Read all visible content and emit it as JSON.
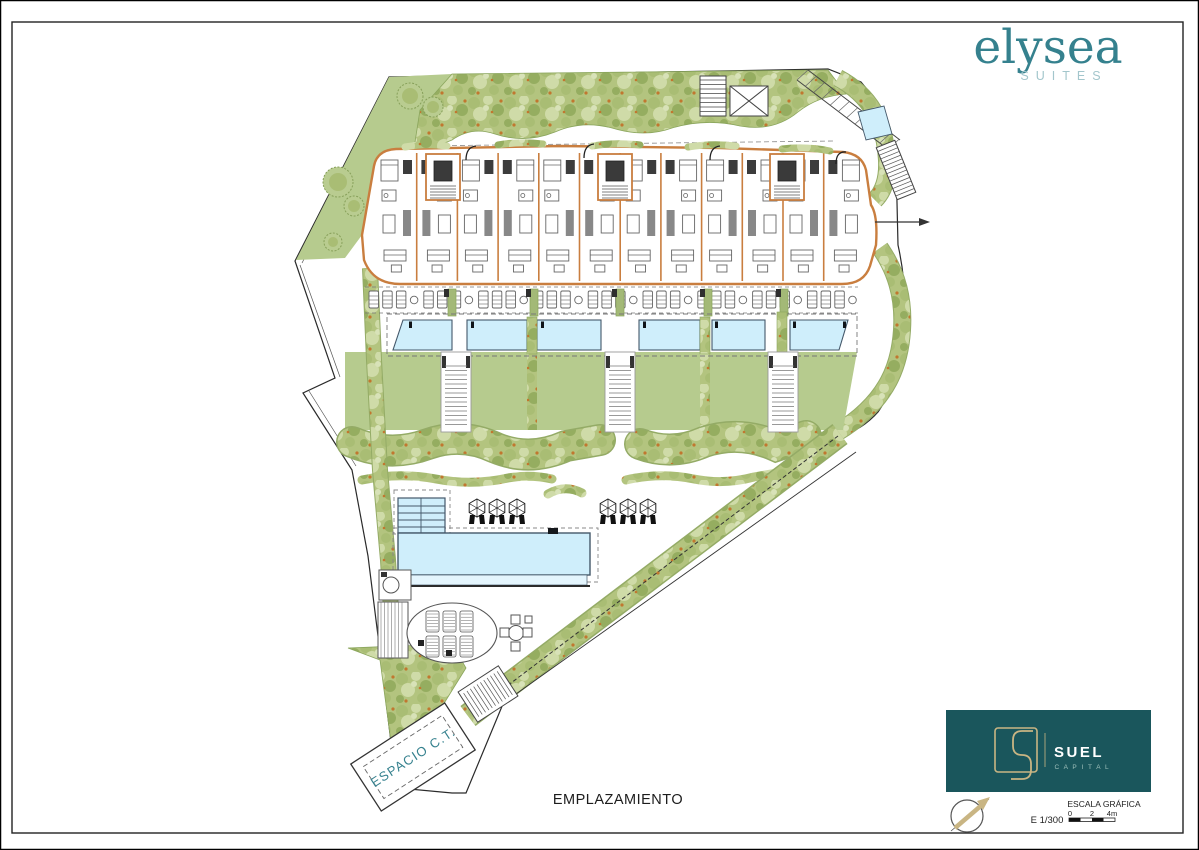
{
  "brand": {
    "name": "elysea",
    "sub": "SUITES"
  },
  "drawing": {
    "title": "EMPLAZAMIENTO",
    "space_label": "ESPACIO C.T."
  },
  "title_block": {
    "company": "SUEL",
    "company_sub": "C A P I T A L",
    "scale_ratio": "E 1/300",
    "scale_title": "ESCALA GRÁFICA",
    "scale_ticks": [
      "0",
      "2",
      "4m"
    ]
  },
  "plan": {
    "parasol_count_left": 3,
    "parasol_count_right": 3,
    "apartment_units": 12,
    "stair_cores": 3,
    "upper_pools": 6,
    "lawn_stairs": 3
  },
  "plan_colors": {
    "lawn": "#b6cb8e",
    "landscape_base": "#b3c47f",
    "tree_dark": "#95ad60",
    "tree_mid": "#a9bd74",
    "tree_light": "#cfdba8",
    "flower": "#c1772f",
    "pool": "#cfeefb",
    "pool_shelf": "#e4f5fd",
    "wall": "#c97e3f",
    "furniture": "#666666",
    "boundary": "#2a2a2a",
    "brand": "#35818e",
    "brand_light": "#a3c6cc",
    "suel_box": "#1a565c",
    "gold": "#c9b583",
    "hedge_edge": "#8aa55c"
  }
}
